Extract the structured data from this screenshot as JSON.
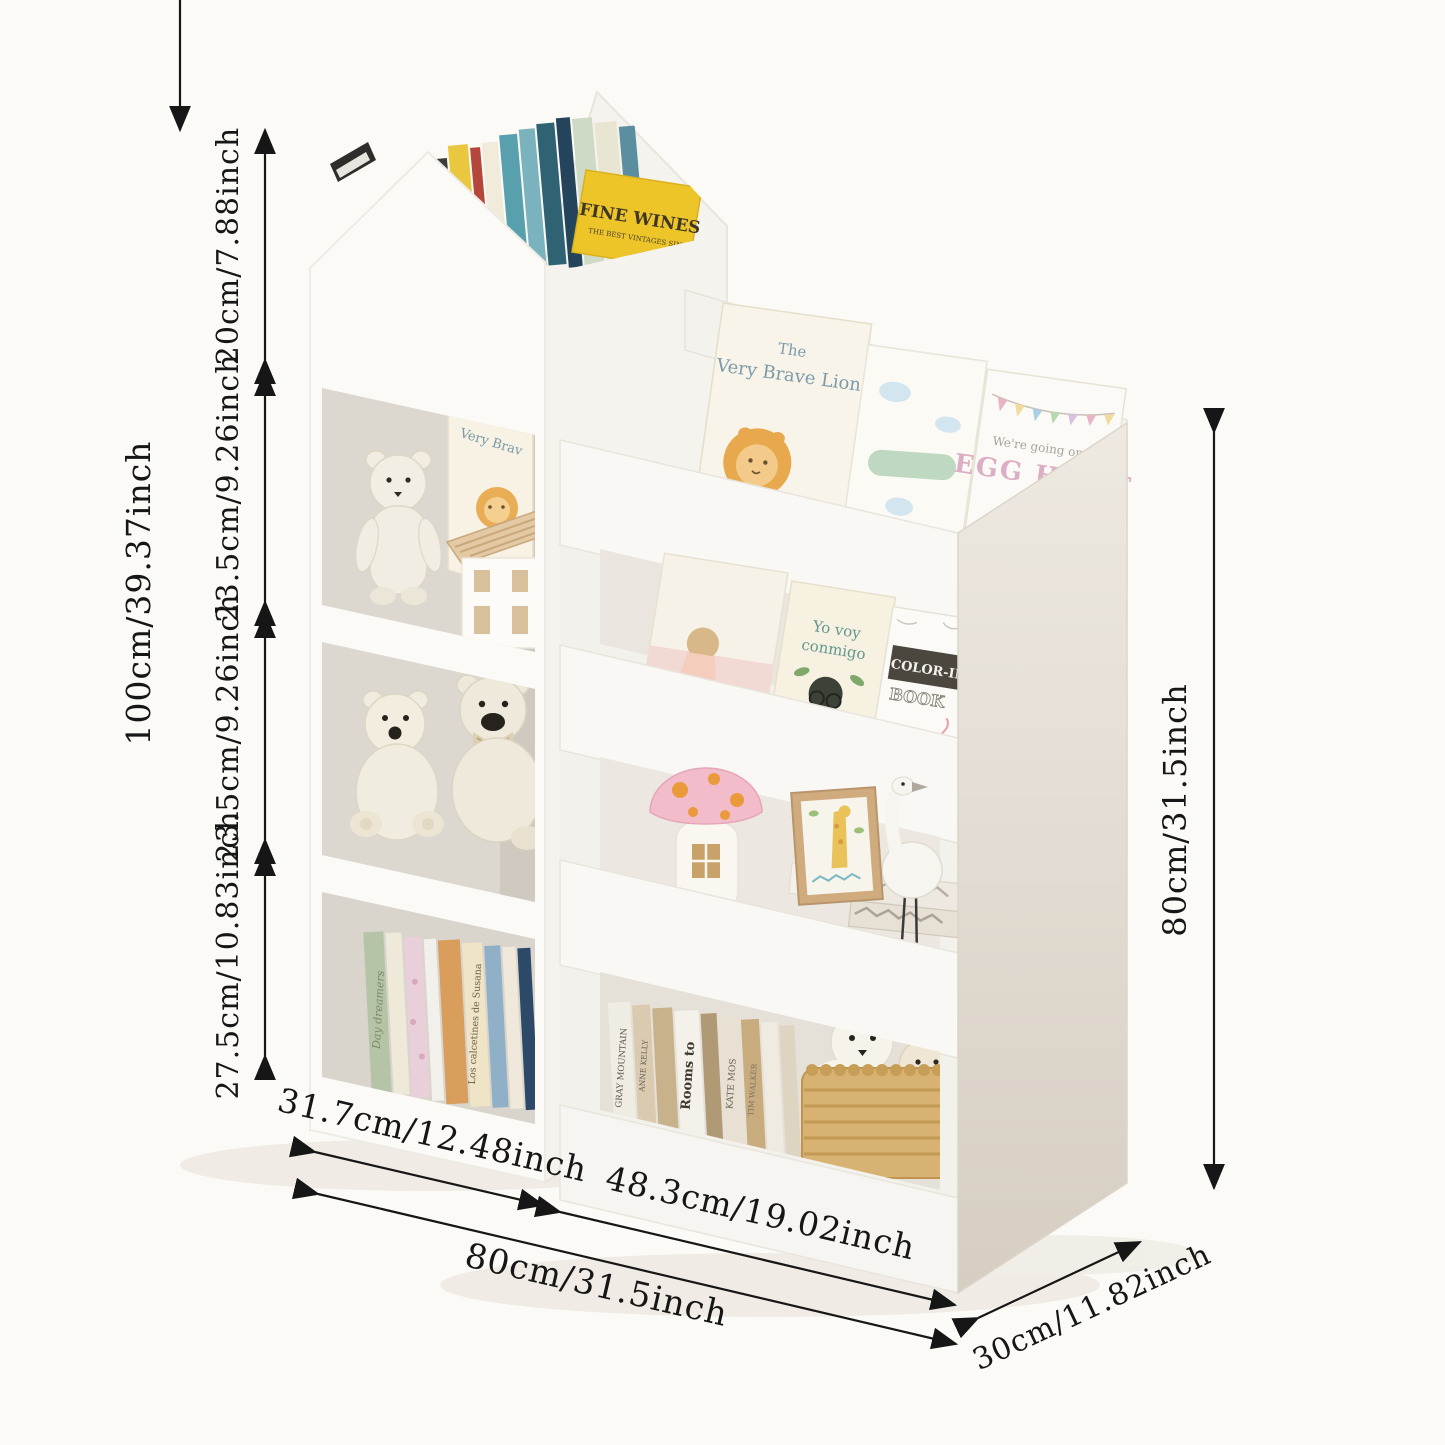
{
  "scene": {
    "background_color": "#fbfaf6",
    "furniture_white": "#faf9f6",
    "interior_grey": "#dcd7cf",
    "side_panel_grey": "#e4ddd3",
    "dimension_line_color": "#161616",
    "description": "Kids bookshelf with house-shaped top bin, left tower of cubbies and right sling display shelves, decorated with teddy bears, picture books and a wicker basket"
  },
  "dimensions": {
    "total_height": "100cm/39.37inch",
    "seg_top": "20cm/7.88inch",
    "seg_mid1": "23.5cm/9.26inch",
    "seg_mid2": "23.5cm/9.26inch",
    "seg_bottom": "27.5cm/10.83inch",
    "right_height": "80cm/31.5inch",
    "left_width": "31.7cm/12.48inch",
    "right_width": "48.3cm/19.02inch",
    "total_width": "80cm/31.5inch",
    "depth": "30cm/11.82inch"
  },
  "books": {
    "fine_wines": "FINE WINES",
    "fine_wines_sub": "THE BEST VINTAGES SINCE",
    "lion_the": "The",
    "lion_title": "Very Brave Lion",
    "cubby_book": "Very Brav",
    "egg_pre": "We're going on an",
    "egg_title": "EGG HUNT",
    "yovoy1": "Yo voy",
    "yovoy2": "conmigo",
    "colorin1": "COLOR-IN",
    "colorin2": "BOOK",
    "wizard": "THE WIZARD",
    "spine_day": "Day dreamers",
    "spine_susana": "Los calcetines de Susana",
    "spine_gray": "GRAY MOUNTAIN",
    "spine_anne": "ANNE KELLY",
    "spine_rooms": "Rooms to",
    "spine_kate": "KATE MOS",
    "spine_tim": "TIM WALKER"
  }
}
